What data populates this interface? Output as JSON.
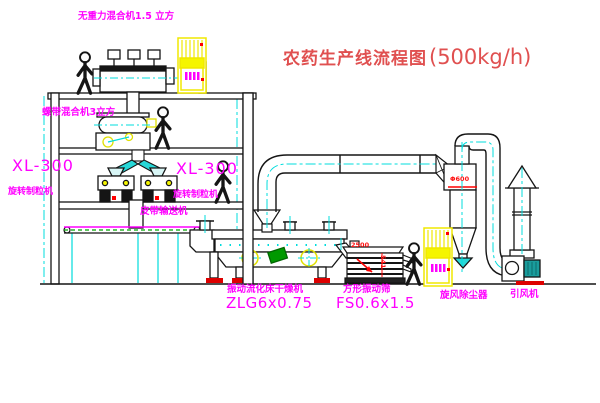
{
  "title": {
    "cn": "农药生产线流程图",
    "capacity": "(500kg/h)"
  },
  "labels": {
    "top_mixer": "无重力混合机1.5 立方",
    "mixer2": "螺带混合机3立方",
    "granulator_model_left": "XL-300",
    "granulator_name_left": "旋转制粒机",
    "granulator_model_mid": "XL-300",
    "granulator_name_mid": "旋转制粒机",
    "conveyor": "皮带输送机",
    "dryer_name": "振动流化床干燥机",
    "dryer_model": "ZLG6x0.75",
    "screen_name": "方形振动筛",
    "screen_model": "FS0.6x1.5",
    "cyclone": "旋风除尘器",
    "fan": "引风机",
    "cyclone_dim": "Φ600",
    "screen_dim_width": "2500",
    "screen_dim_height": "541"
  },
  "colors": {
    "label_magenta": "#ff00ff",
    "title_red": "#e05050",
    "accent_red": "#ff0000",
    "cabinet_yellow": "#f5f500",
    "centerline_cyan": "#00dcdc",
    "belt_green": "#00a000",
    "motor_teal": "#1a9c9c",
    "line_black": "#151515"
  }
}
